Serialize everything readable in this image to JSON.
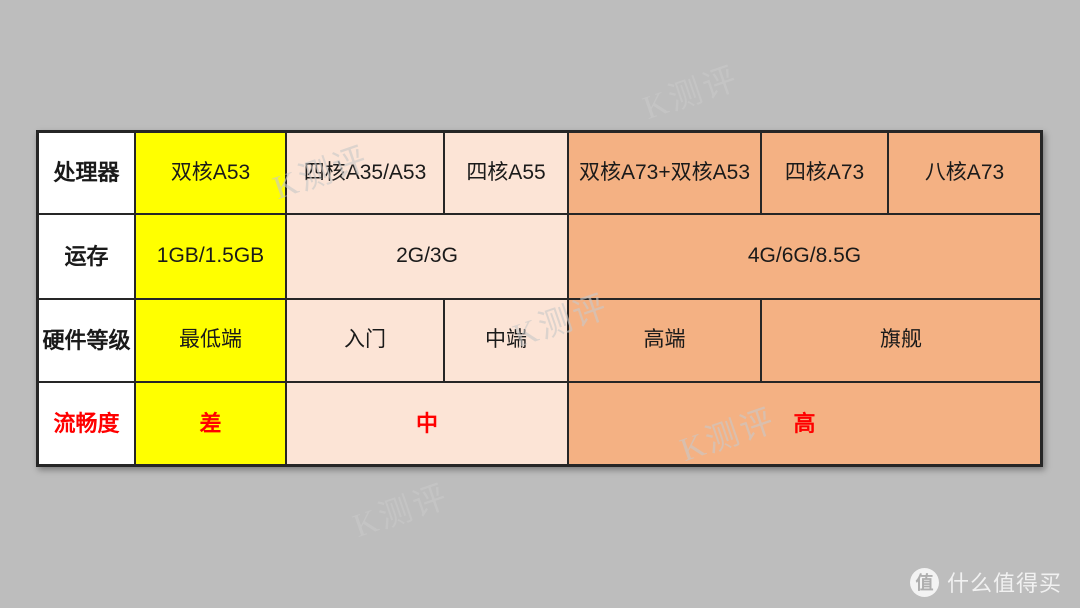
{
  "canvas": {
    "width": 1080,
    "height": 608,
    "background": "#bdbdbd"
  },
  "colors": {
    "tier_low_yellow": "#ffff00",
    "tier_mid_peach": "#fce4d6",
    "tier_high_orange": "#f4b183",
    "header_bg": "#ffffff",
    "grid_line": "#262626",
    "text": "#1a1a1a",
    "accent_red": "#ff0000",
    "watermark_gray": "#c8c8c8"
  },
  "watermark": {
    "text": "K测评"
  },
  "logo": {
    "badge": "值",
    "name": "什么值得买"
  },
  "table": {
    "rows": [
      {
        "header": "处理器",
        "cells": [
          {
            "text": "双核A53"
          },
          {
            "text": "四核A35/A53"
          },
          {
            "text": "四核A55"
          },
          {
            "text": "双核A73+双核A53"
          },
          {
            "text": "四核A73"
          },
          {
            "text": "八核A73"
          }
        ]
      },
      {
        "header": "运存",
        "cells": [
          {
            "text": "1GB/1.5GB"
          },
          {
            "text": "2G/3G"
          },
          {
            "text": "4G/6G/8.5G"
          }
        ]
      },
      {
        "header": "硬件等级",
        "cells": [
          {
            "text": "最低端"
          },
          {
            "text": "入门"
          },
          {
            "text": "中端"
          },
          {
            "text": "高端"
          },
          {
            "text": "旗舰"
          }
        ]
      },
      {
        "header": "流畅度",
        "cells": [
          {
            "text": "差"
          },
          {
            "text": "中"
          },
          {
            "text": "高"
          }
        ]
      }
    ]
  },
  "chart_data": {
    "type": "table",
    "title": "",
    "row_headers": [
      "处理器",
      "运存",
      "硬件等级",
      "流畅度"
    ],
    "tiers": [
      {
        "processor": "双核A53",
        "ram": "1GB/1.5GB",
        "grade": "最低端",
        "fluency": "差",
        "fill": "#ffff00"
      },
      {
        "processor": "四核A35/A53",
        "ram": "2G/3G",
        "grade": "入门",
        "fluency": "中",
        "fill": "#fce4d6"
      },
      {
        "processor": "四核A55",
        "ram": "2G/3G",
        "grade": "中端",
        "fluency": "中",
        "fill": "#fce4d6"
      },
      {
        "processor": "双核A73+双核A53",
        "ram": "4G/6G/8.5G",
        "grade": "高端",
        "fluency": "高",
        "fill": "#f4b183"
      },
      {
        "processor": "四核A73",
        "ram": "4G/6G/8.5G",
        "grade": "旗舰",
        "fluency": "高",
        "fill": "#f4b183"
      },
      {
        "processor": "八核A73",
        "ram": "4G/6G/8.5G",
        "grade": "旗舰",
        "fluency": "高",
        "fill": "#f4b183"
      }
    ],
    "notes": "Merged cells: 2G/3G spans columns 2-3; 4G/6G/8.5G spans columns 4-6; 旗舰 spans columns 5-6; 中 spans columns 2-3; 高 spans columns 4-6."
  }
}
